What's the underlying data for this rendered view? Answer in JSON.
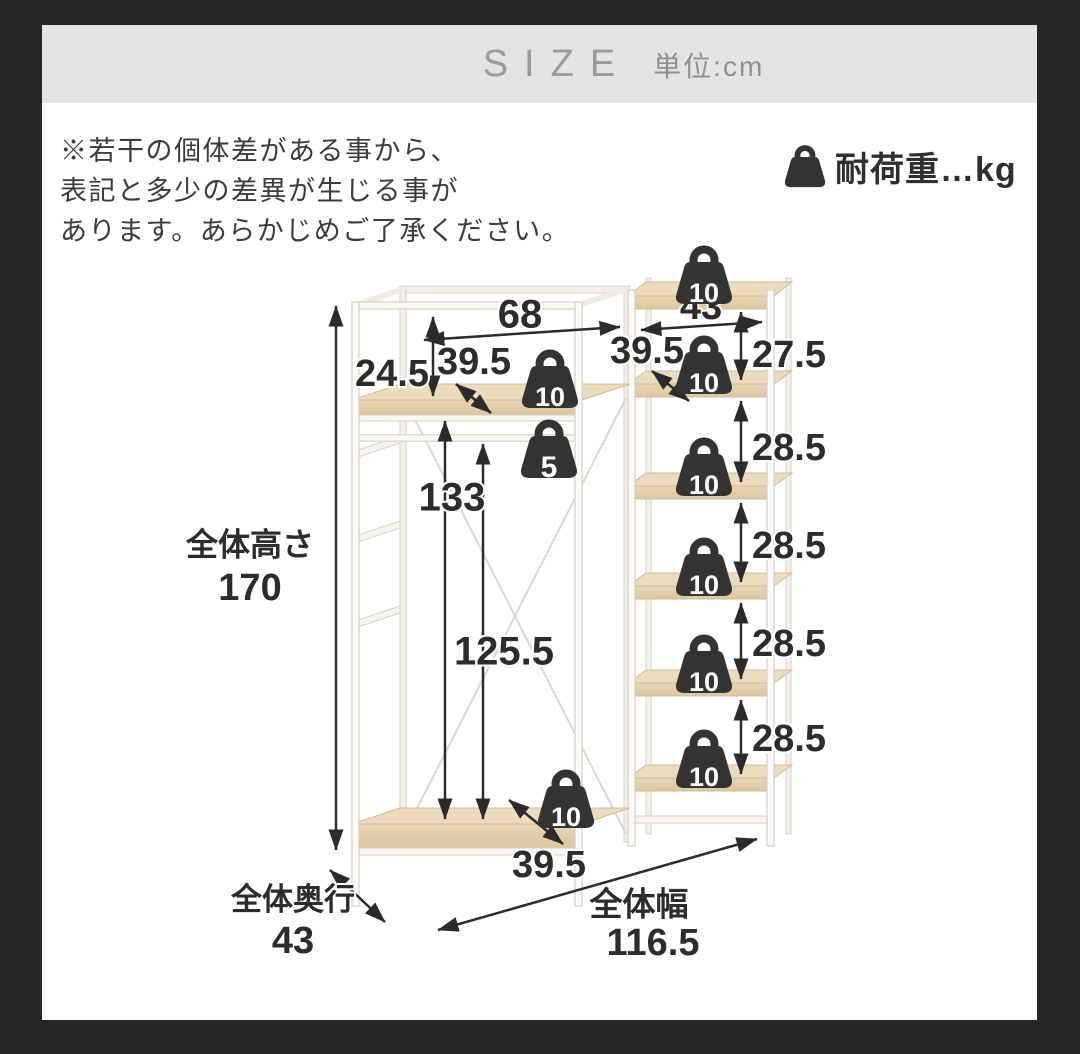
{
  "header": {
    "title": "SIZE",
    "unit_label": "単位:cm"
  },
  "note": {
    "lines": [
      "※若干の個体差がある事から、",
      "表記と多少の差異が生じる事が",
      "あります。あらかじめご了承ください。"
    ]
  },
  "legend": {
    "label": "耐荷重…kg"
  },
  "diagram": {
    "dim_labels": {
      "left_top_width": "68",
      "right_top_width": "43",
      "left_top_clearance": "24.5",
      "left_shelf_depth": "39.5",
      "right_shelf_depth": "39.5",
      "right_top_gap": "27.5",
      "right_gap_1": "28.5",
      "right_gap_2": "28.5",
      "right_gap_3": "28.5",
      "right_gap_4": "28.5",
      "hanger_inner_height": "133",
      "hanger_clearance": "125.5",
      "bottom_shelf_depth": "39.5"
    },
    "jp": {
      "height_label": "全体高さ",
      "height_value": "170",
      "depth_label": "全体奥行",
      "depth_value": "43",
      "width_label": "全体幅",
      "width_value": "116.5"
    },
    "loads_kg": {
      "left_top_shelf": "10",
      "hanger_rod": "5",
      "right_top": "10",
      "right_shelf_2": "10",
      "right_shelf_3": "10",
      "right_shelf_4": "10",
      "right_shelf_5": "10",
      "right_shelf_6": "10",
      "bottom_shelf": "10"
    }
  }
}
